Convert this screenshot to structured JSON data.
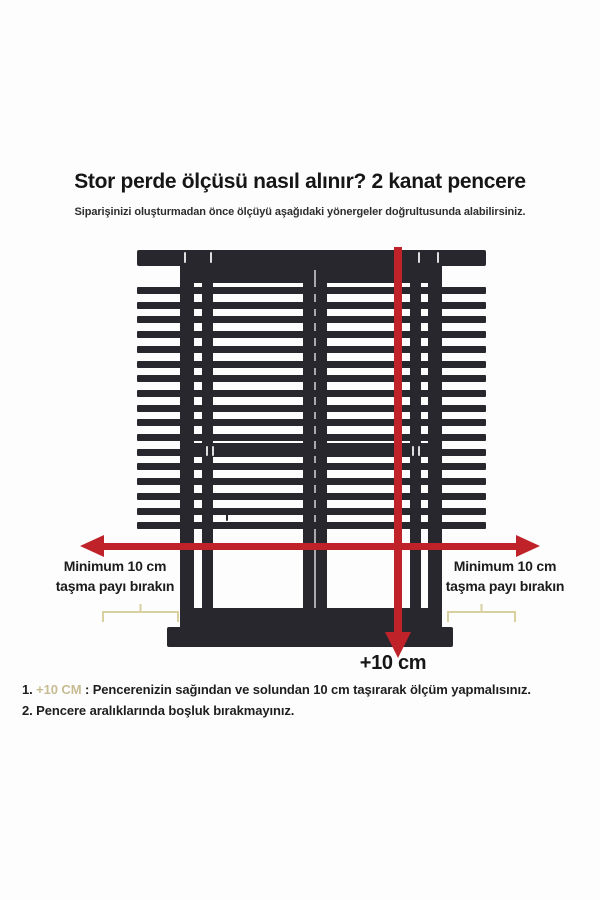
{
  "header": {
    "title": "Stor perde ölçüsü nasıl alınır? 2 kanat pencere",
    "subtitle": "Siparişinizi oluşturmadan önce ölçüyü aşağıdaki yönergeler doğrultusunda alabilirsiniz."
  },
  "diagram": {
    "blind": {
      "slat_count": 17
    },
    "left_label": {
      "line1": "Minimum 10 cm",
      "line2": "taşma payı bırakın"
    },
    "right_label": {
      "line1": "Minimum 10 cm",
      "line2": "taşma payı bırakın"
    },
    "bottom_label": "+10 cm"
  },
  "notes": [
    {
      "number": "1.",
      "highlight": "+10 CM",
      "text": ": Pencerenizin sağından ve solundan 10 cm taşırarak ölçüm yapmalısınız."
    },
    {
      "number": "2.",
      "highlight": "",
      "text": "Pencere aralıklarında boşluk bırakmayınız."
    }
  ],
  "colors": {
    "arrow_red": "#bf2229",
    "frame_dark": "#28272d",
    "bracket_tan": "#d8d09e",
    "note_highlight": "#c8bc93"
  }
}
